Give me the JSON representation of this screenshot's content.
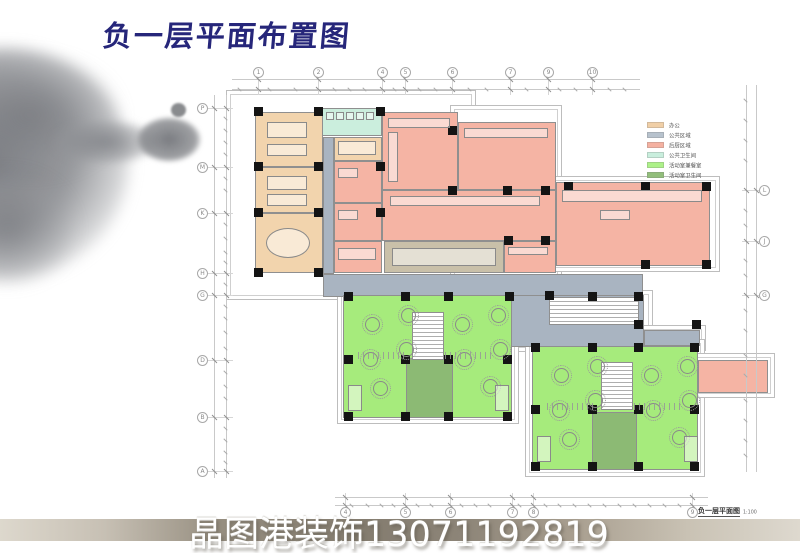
{
  "title": {
    "text": "负一层平面布置图",
    "color": "#26267a"
  },
  "watermark": {
    "text": "晶图港装饰13071192819"
  },
  "title_block": {
    "name": "负一层平面图",
    "scale": "1:100",
    "note": "本层建筑面积约750㎡"
  },
  "legend": {
    "items": [
      {
        "key": "office",
        "label": "办公",
        "color": "#f0cfa7"
      },
      {
        "key": "corridor",
        "label": "公共区域",
        "color": "#b7c2cd"
      },
      {
        "key": "kitchen",
        "label": "后厨区域",
        "color": "#f4b1a1"
      },
      {
        "key": "wc",
        "label": "公共卫生间",
        "color": "#c9eedd"
      },
      {
        "key": "activity",
        "label": "活动室兼餐室",
        "color": "#adf189"
      },
      {
        "key": "activity_wc",
        "label": "活动室卫生间",
        "color": "#92be7b"
      }
    ]
  },
  "fills": {
    "office": "#f2d4ad",
    "corridor": "#a9b4c1",
    "kitchen": "#f5b4a4",
    "wc": "#cbeedd",
    "activity": "#a6eb7c",
    "activity_wc": "#8cba74",
    "dining": "#c9c0a9",
    "stair": "#ffffff"
  },
  "axes": {
    "top": [
      {
        "label": "1",
        "x": 258
      },
      {
        "label": "2",
        "x": 318
      },
      {
        "label": "4",
        "x": 382
      },
      {
        "label": "5",
        "x": 405
      },
      {
        "label": "6",
        "x": 452
      },
      {
        "label": "7",
        "x": 510
      },
      {
        "label": "9",
        "x": 548
      },
      {
        "label": "10",
        "x": 592
      }
    ],
    "bottom": [
      {
        "label": "4",
        "x": 345
      },
      {
        "label": "5",
        "x": 405
      },
      {
        "label": "6",
        "x": 450
      },
      {
        "label": "7",
        "x": 512
      },
      {
        "label": "8",
        "x": 533
      },
      {
        "label": "9",
        "x": 692
      }
    ],
    "left": [
      {
        "label": "P",
        "y": 108
      },
      {
        "label": "M",
        "y": 167
      },
      {
        "label": "K",
        "y": 213
      },
      {
        "label": "H",
        "y": 273
      },
      {
        "label": "G",
        "y": 295
      },
      {
        "label": "D",
        "y": 360
      },
      {
        "label": "B",
        "y": 417
      },
      {
        "label": "A",
        "y": 471
      }
    ],
    "right": [
      {
        "label": "L",
        "y": 190
      },
      {
        "label": "J",
        "y": 241
      },
      {
        "label": "G",
        "y": 295
      }
    ]
  },
  "plan": {
    "shells": [
      [
        226,
        90,
        250,
        210
      ],
      [
        450,
        105,
        112,
        195
      ],
      [
        550,
        176,
        170,
        96
      ],
      [
        503,
        290,
        150,
        62
      ],
      [
        640,
        325,
        66,
        26
      ],
      [
        337,
        288,
        182,
        136
      ],
      [
        525,
        339,
        180,
        138
      ],
      [
        693,
        353,
        82,
        45
      ]
    ],
    "rooms": [
      {
        "cat": "office",
        "x": 255,
        "y": 112,
        "w": 68,
        "h": 55
      },
      {
        "cat": "office",
        "x": 255,
        "y": 167,
        "w": 68,
        "h": 46
      },
      {
        "cat": "office",
        "x": 255,
        "y": 213,
        "w": 68,
        "h": 60
      },
      {
        "cat": "office",
        "x": 334,
        "y": 137,
        "w": 48,
        "h": 24
      },
      {
        "cat": "wc",
        "x": 322,
        "y": 108,
        "w": 60,
        "h": 28
      },
      {
        "cat": "corridor",
        "x": 323,
        "y": 137,
        "w": 11,
        "h": 137
      },
      {
        "cat": "corridor",
        "x": 323,
        "y": 274,
        "w": 320,
        "h": 23
      },
      {
        "cat": "corridor",
        "x": 510,
        "y": 295,
        "w": 134,
        "h": 52
      },
      {
        "cat": "corridor",
        "x": 644,
        "y": 330,
        "w": 56,
        "h": 16
      },
      {
        "cat": "kitchen",
        "x": 382,
        "y": 112,
        "w": 76,
        "h": 78
      },
      {
        "cat": "kitchen",
        "x": 458,
        "y": 122,
        "w": 98,
        "h": 68
      },
      {
        "cat": "kitchen",
        "x": 382,
        "y": 190,
        "w": 174,
        "h": 51
      },
      {
        "cat": "kitchen",
        "x": 556,
        "y": 182,
        "w": 154,
        "h": 84
      },
      {
        "cat": "kitchen",
        "x": 504,
        "y": 241,
        "w": 52,
        "h": 32
      },
      {
        "cat": "kitchen",
        "x": 334,
        "y": 161,
        "w": 48,
        "h": 42
      },
      {
        "cat": "kitchen",
        "x": 334,
        "y": 203,
        "w": 48,
        "h": 38
      },
      {
        "cat": "kitchen",
        "x": 334,
        "y": 241,
        "w": 48,
        "h": 32
      },
      {
        "cat": "kitchen",
        "x": 698,
        "y": 360,
        "w": 70,
        "h": 33
      },
      {
        "cat": "dining",
        "x": 384,
        "y": 241,
        "w": 120,
        "h": 32
      },
      {
        "cat": "activity",
        "x": 343,
        "y": 295,
        "w": 169,
        "h": 123
      },
      {
        "cat": "activity",
        "x": 532,
        "y": 346,
        "w": 166,
        "h": 124
      },
      {
        "cat": "activity_wc",
        "x": 406,
        "y": 358,
        "w": 47,
        "h": 60
      },
      {
        "cat": "activity_wc",
        "x": 592,
        "y": 412,
        "w": 45,
        "h": 58
      },
      {
        "cat": "stair",
        "x": 412,
        "y": 312,
        "w": 32,
        "h": 48
      },
      {
        "cat": "stair",
        "x": 601,
        "y": 362,
        "w": 32,
        "h": 48
      },
      {
        "cat": "stair",
        "x": 549,
        "y": 297,
        "w": 90,
        "h": 28
      }
    ],
    "columns": [
      [
        258,
        111
      ],
      [
        318,
        111
      ],
      [
        380,
        111
      ],
      [
        258,
        166
      ],
      [
        318,
        166
      ],
      [
        380,
        166
      ],
      [
        258,
        212
      ],
      [
        318,
        212
      ],
      [
        380,
        212
      ],
      [
        258,
        272
      ],
      [
        318,
        272
      ],
      [
        452,
        130
      ],
      [
        452,
        190
      ],
      [
        507,
        190
      ],
      [
        545,
        190
      ],
      [
        508,
        240
      ],
      [
        545,
        240
      ],
      [
        568,
        186
      ],
      [
        645,
        186
      ],
      [
        706,
        186
      ],
      [
        645,
        264
      ],
      [
        706,
        264
      ],
      [
        348,
        296
      ],
      [
        405,
        296
      ],
      [
        448,
        296
      ],
      [
        509,
        296
      ],
      [
        348,
        359
      ],
      [
        405,
        359
      ],
      [
        448,
        359
      ],
      [
        507,
        359
      ],
      [
        348,
        416
      ],
      [
        405,
        416
      ],
      [
        448,
        416
      ],
      [
        507,
        416
      ],
      [
        549,
        295
      ],
      [
        592,
        296
      ],
      [
        638,
        296
      ],
      [
        638,
        324
      ],
      [
        696,
        324
      ],
      [
        535,
        347
      ],
      [
        592,
        347
      ],
      [
        638,
        347
      ],
      [
        694,
        347
      ],
      [
        535,
        409
      ],
      [
        592,
        409
      ],
      [
        638,
        409
      ],
      [
        694,
        409
      ],
      [
        535,
        466
      ],
      [
        592,
        466
      ],
      [
        638,
        466
      ],
      [
        694,
        466
      ]
    ]
  }
}
